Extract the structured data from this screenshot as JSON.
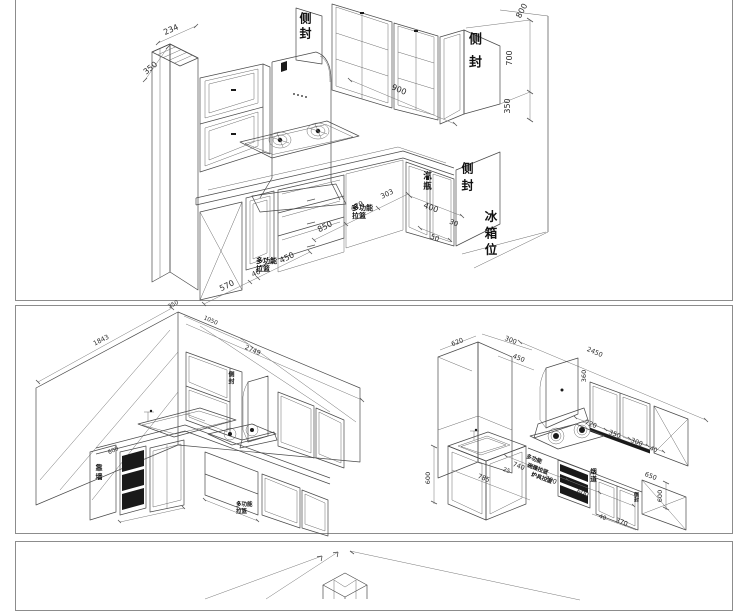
{
  "page": {
    "background": "#ffffff",
    "line_color": "#4a4a4a",
    "accent_black": "#1a1a1a",
    "border_color": "#8c8c8c"
  },
  "sheet1": {
    "labels": {
      "end_panel_top": "侧封",
      "end_panel_right": "侧封",
      "gas_bottle": "汽瓶",
      "end_panel_base": "侧封",
      "fridge_position": "冰箱位",
      "basket_left_l1": "多功能",
      "basket_left_l2": "拉篮",
      "basket_mid_l1": "多功能",
      "basket_mid_l2": "拉篮"
    },
    "dims": {
      "d234": "234",
      "d350_left": "350",
      "d800": "800",
      "d700": "700",
      "d350_right": "350",
      "d900": "900",
      "d570": "570",
      "d40": "40",
      "d450": "450",
      "d850": "850",
      "d479": "479",
      "d303": "303",
      "d400": "400",
      "d30": "30",
      "d50": "50"
    }
  },
  "sheet2_left": {
    "labels": {
      "end_panel": "侧封",
      "against_wall": "靠墙",
      "basket_l1": "多功能",
      "basket_l2": "拉篮"
    },
    "dims": {
      "d1843": "1843",
      "d350": "350",
      "d1050": "1050",
      "d2749": "2749",
      "d600": "600"
    }
  },
  "sheet2_right": {
    "labels": {
      "multi_function": "多功能",
      "dish_basket": "碗碟拉篮",
      "stove_basket": "炉具拉篮",
      "flue": "烟道",
      "end_panel": "侧封"
    },
    "dims": {
      "d620": "620",
      "d300_top": "300",
      "d450": "450",
      "d2450": "2450",
      "d360": "360",
      "d720": "720",
      "d350": "350",
      "d300": "300",
      "d40_top": "40",
      "d650": "650",
      "d600_right": "600",
      "d600_left": "600",
      "d785": "785",
      "d25": "25",
      "d740": "740",
      "d700": "700",
      "d600_bottom": "600",
      "d370": "370",
      "d40_bottom": "40"
    }
  }
}
